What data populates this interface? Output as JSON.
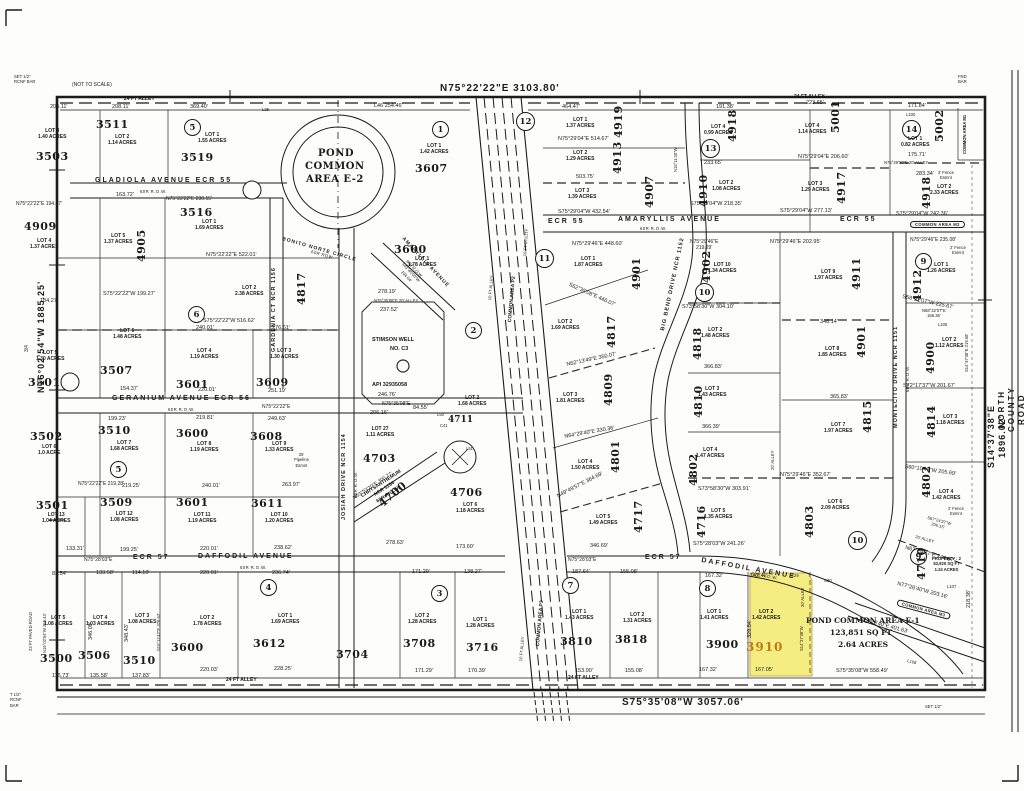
{
  "colors": {
    "ink": "#1b1b1b",
    "paper": "#fdfdfb",
    "highlight_fill": "#f5ec82",
    "highlight_text": "#c07a1a"
  },
  "boundary": {
    "north": "N75°22'22\"E   3103.80'",
    "south": "S75°35'08\"W   3057.06'",
    "west": "N16°02'54\"W   1885.25'",
    "east": "S14°37'38\"E   1896.02'"
  },
  "notes": {
    "set_bar": "SET 1/2\"\nRCNF BAR",
    "not_to_scale": "(NOT TO SCALE)",
    "fnd_bar": "FND\nBAR",
    "t_bar": "T 1/2\"\nRCNF\nBAR",
    "set_half": "SET 1/2\"",
    "three_quarter": "3/4"
  },
  "features": {
    "pond_e2": [
      "POND",
      "COMMON",
      "AREA E-2"
    ],
    "pond_e1": [
      "POND COMMON AREA E-1",
      "123,851 SQ FT",
      "2.64 ACRES"
    ],
    "well": [
      "STIMSON  WELL",
      "NO. C3",
      "API 32935058"
    ]
  },
  "streets": [
    {
      "label": "GLADIOLA AVENUE  ECR 55"
    },
    {
      "label": "60R R.O.W."
    },
    {
      "label": "ECR 55"
    },
    {
      "label": "AMARYLLIS AVENUE"
    },
    {
      "label": "ECR 55"
    },
    {
      "label": "60R R.O.W."
    },
    {
      "label": "GERANIUM AVENUE  ECR 56"
    },
    {
      "label": "60R R.O.W."
    },
    {
      "label": "N75°22'22\"E"
    },
    {
      "label": "N75°28'03\"E"
    },
    {
      "label": "ECR 57"
    },
    {
      "label": "DAFFODIL AVENUE"
    },
    {
      "label": "60R R.O.W."
    },
    {
      "label": "N75°28'03\"E"
    },
    {
      "label": "ECR 57"
    },
    {
      "label": "DAFFODIL AVENUE"
    },
    {
      "label": "60R R.O.W."
    },
    {
      "label": "JOSIAH DRIVE NCR 1154"
    },
    {
      "label": "60R R.O.W."
    },
    {
      "label": "GARDENIA CT NCR 1156"
    },
    {
      "label": "BIG BEND DRIVE NCR 1152"
    },
    {
      "label": "MONTECITO DRIVE NCR 1151"
    },
    {
      "label": "60R R.O.W."
    },
    {
      "label": "BONITO NORTE CIRCLE"
    },
    {
      "label": "60R ROW"
    },
    {
      "label": "CHRYSANTHEMUM\nNCR 1154\n60R R.O.W."
    },
    {
      "label": "AMARYLLIS AVENUE"
    },
    {
      "label": "NORTH COUNTY ROAD 1150"
    },
    {
      "label": "10 FT ALLEY"
    },
    {
      "label": "COMMON AREA P2"
    },
    {
      "label": "10 FT UTILITY"
    },
    {
      "label": "COMMON AREA P3"
    },
    {
      "label": "10 FT ALLEY"
    }
  ],
  "blocks": [
    "5",
    "1",
    "12",
    "13",
    "14",
    "11",
    "2",
    "6",
    "10",
    "9",
    "5",
    "4",
    "3",
    "7",
    "8",
    "10",
    "9"
  ],
  "lots": [
    {
      "n": "3503",
      "d": "LOT 3\n1.40 ACRES"
    },
    {
      "n": "3511",
      "d": "LOT 2\n1.14 ACRES"
    },
    {
      "n": "3519",
      "d": "LOT 1\n1.55 ACRES"
    },
    {
      "n": "3607",
      "d": "LOT 1\n1.42 ACRES"
    },
    {
      "n": "3516",
      "d": "LOT 1\n1.69 ACRES"
    },
    {
      "n": "4909",
      "d": "LOT 4\n1.37 ACRES"
    },
    {
      "n": "4905",
      "d": "LOT 5\n1.37 ACRES"
    },
    {
      "n": "3600",
      "d": "LOT 1\n1.78 ACRES"
    },
    {
      "n": "4817",
      "d": "LOT 2\n2.38 ACRES"
    },
    {
      "n": "3507",
      "d": "LOT 6\n1.48 ACRES"
    },
    {
      "n": "3501",
      "d": "LOT 5\n1.30 ACRES"
    },
    {
      "n": "3601",
      "d": "LOT 4\n1.19 ACRES"
    },
    {
      "n": "3609",
      "d": "LOT 3\n1.30 ACRES"
    },
    {
      "n": "3502",
      "d": "LOT 6\n1.0 ACRE"
    },
    {
      "n": "3510",
      "d": "LOT 7\n1.68 ACRES"
    },
    {
      "n": "3600",
      "d": "LOT 8\n1.19 ACRES"
    },
    {
      "n": "3608",
      "d": "LOT 9\n1.33 ACRES"
    },
    {
      "n": "3501",
      "d": "LOT 13\n1.04 ACRES"
    },
    {
      "n": "3509",
      "d": "LOT 12\n1.08 ACRES"
    },
    {
      "n": "3601",
      "d": "LOT 11\n1.19 ACRES"
    },
    {
      "n": "3611",
      "d": "LOT 10\n1.20 ACRES"
    },
    {
      "n": "3500",
      "d": "LOT 5\n1.08 ACRES"
    },
    {
      "n": "3506",
      "d": "LOT 4\n1.03 ACRES"
    },
    {
      "n": "3510",
      "d": "LOT 3\n1.08 ACRES"
    },
    {
      "n": "3600",
      "d": "LOT 2\n1.78 ACRES"
    },
    {
      "n": "3612",
      "d": "LOT 1\n1.69 ACRES"
    },
    {
      "n": "3704",
      "d": ""
    },
    {
      "n": "3708",
      "d": "LOT 2\n1.28 ACRES"
    },
    {
      "n": "3716",
      "d": "LOT 1\n1.28 ACRES"
    },
    {
      "n": "3810",
      "d": "LOT 1\n1.43 ACRES"
    },
    {
      "n": "3818",
      "d": "LOT 2\n1.31 ACRES"
    },
    {
      "n": "3900",
      "d": "LOT 1\n1.41 ACRES"
    },
    {
      "n": "3910",
      "d": "LOT 2\n1.42 ACRES"
    },
    {
      "n": "4703",
      "d": "LOT 27\n1.11 ACRES"
    },
    {
      "n": "4700",
      "d": ""
    },
    {
      "n": "4706",
      "d": "LOT 6\n1.18 ACRES"
    },
    {
      "n": "4711",
      "d": "LOT 2\n1.68 ACRES"
    },
    {
      "n": "4901",
      "d": "LOT 1\n1.87 ACRES"
    },
    {
      "n": "4817",
      "d": "LOT 2\n1.69 ACRES"
    },
    {
      "n": "4809",
      "d": "LOT 3\n1.81 ACRES"
    },
    {
      "n": "4801",
      "d": "LOT 4\n1.50 ACRES"
    },
    {
      "n": "4717",
      "d": "LOT 5\n1.49 ACRES"
    },
    {
      "n": "4902",
      "d": "LOT 10\n1.34 ACRES"
    },
    {
      "n": "4818",
      "d": "LOT 2\n1.48 ACRES"
    },
    {
      "n": "4810",
      "d": "LOT 3\n1.43 ACRES"
    },
    {
      "n": "4802",
      "d": "LOT 4\n1.47 ACRES"
    },
    {
      "n": "4716",
      "d": "LOT 5\n1.35 ACRES"
    },
    {
      "n": "4803",
      "d": "LOT 6\n2.09 ACRES"
    },
    {
      "n": "4815",
      "d": "LOT 7\n1.97 ACRES"
    },
    {
      "n": "4901",
      "d": "LOT 8\n1.85 ACRES"
    },
    {
      "n": "4911",
      "d": "LOT 9\n1.97 ACRES"
    },
    {
      "n": "4912",
      "d": "LOT 1\n1.26 ACRES"
    },
    {
      "n": "4900",
      "d": "LOT 2\n1.12 ACRES"
    },
    {
      "n": "4814",
      "d": "LOT 3\n1.18 ACRES"
    },
    {
      "n": "4802",
      "d": "LOT 4\n1.42 ACRES"
    },
    {
      "n": "4710",
      "d": "PROPERTY : 2\n53,920 SQ FT\n1.24 ACRES"
    },
    {
      "n": "4919",
      "d": "LOT 1\n1.37 ACRES"
    },
    {
      "n": "4913",
      "d": "LOT 2\n1.29 ACRES"
    },
    {
      "n": "4907",
      "d": "LOT 3\n1.39 ACRES"
    },
    {
      "n": "4918",
      "d": "LOT 4\n0.99 ACRES"
    },
    {
      "n": "4910",
      "d": "LOT 2\n1.08 ACRES"
    },
    {
      "n": "5001",
      "d": "LOT 4\n1.14 ACRES"
    },
    {
      "n": "4917",
      "d": "LOT 3\n1.29 ACRES"
    },
    {
      "n": "5002",
      "d": "LOT 1\n0.82 ACRES"
    },
    {
      "n": "4918",
      "d": "LOT 2\n2.33 ACRES"
    }
  ],
  "dims": [
    "206.11'",
    "208.11'",
    "369.40'",
    "L46  254.46'",
    "464.47'",
    "191.38'",
    "223.65'",
    "171.84'",
    "L100",
    "24 FT ALLEY",
    "24 FT ALLEY",
    "N75°29'04\"E 514.67'",
    "503.75'",
    "S75°29'04\"W 432.54'",
    "233.65'",
    "S75°29'04\"W 218.35'",
    "N75°29'04\"E 206.60'",
    "S75°29'04\"W 277.13'",
    "175.71'",
    "N75°29'50\"E  20' ALLEY",
    "283.34'",
    "2' Fence\nEsmnt",
    "S75°29'04\"W 242.36'",
    "COMMON AREA M2",
    "N75°29'46\"E 235.08'",
    "2' Fence\nEsmnt",
    "N75°29'46\"E 448.60'",
    "N75°29'46\"E\n219.29'",
    "N75°29'46\"E 202.95'",
    "S62°35'08\"E 446.07'",
    "N62°13'49\"E 350.07'",
    "N64°29'40\"E 330.36'",
    "N49°49'57\"E 364.69'",
    "S73°58'30\"W 304.10'",
    "348.14'",
    "366.83'",
    "365.83'",
    "366.39'",
    "N75°29'46\"E 352.67'",
    "S73°58'30\"W 303.91'",
    "S75°28'03\"W 241.26'",
    "S60°10'49\"W 205.69'",
    "S58°22'07\"W 225.67'",
    "N68°22'07\"E\n166.36'",
    "L105",
    "S72°17'37\"W 201.67'",
    "S67°24'37\"W\n200.15'",
    "N67°24'37\"E 244.67'",
    "20' ALLEY",
    "2' Fence\nEsmnt",
    "N77°26'40\"W 203.16'",
    "L107",
    "COMMON AREA M3",
    "S77°26'40\"E 401.63'",
    "S75°35'08\"W 558.49'",
    "184.27'",
    "N75°22'22\"E 194.27'",
    "163.72'",
    "N75°22'22\"E 230.15'",
    "N75°22'22\"E 522.01'",
    "S75°22'22\"W 516.62'",
    "240.01'",
    "276.61'",
    "S75°22'22\"W 199.27'",
    "154.37'",
    "220.01'",
    "251.19'",
    "199.23'",
    "219.81'",
    "249.63'",
    "25'\nPipeline\nEsmnt",
    "N75°22'22\"E 219.28'",
    "219.25'",
    "240.01'",
    "263.97'",
    "133.31'",
    "199.25'",
    "220.01'",
    "238.62'",
    "83.54'",
    "133.58'",
    "114.10'",
    "220.01'",
    "236.74'",
    "115.73'",
    "135.58'",
    "137.83'",
    "220.03'",
    "228.25'",
    "24 FT ALLEY",
    "24 FT ALLEY",
    "278.63'",
    "173.60'",
    "346.69'",
    "171.29'",
    "138.27'",
    "187.64'",
    "155.08'",
    "171.29'",
    "170.39'",
    "153.90'",
    "155.08'",
    "167.32'",
    "142.42'",
    "C29",
    "C30",
    "329.84'",
    "167.05'",
    "167.32'",
    "S14°37'38\"W",
    "20' ALLEY",
    "278.19'",
    "N75°35'08\"E   20' ALLEY",
    "237.52'",
    "246.76'",
    "N75°35'08\"E",
    "206.16'",
    "84.55'",
    "N53°53'20\"E 300.77'",
    "L50",
    "C41",
    "L51",
    "N15°11'40\"W",
    "S15°11'42\"E 328.62'",
    "346.09'",
    "348.43'",
    "N16°02'54\"W 255.43'",
    "23 FT PAVED ROAD",
    "S14°37'38\"E 219.68'",
    "218.38'",
    "20' ALLEY",
    "L25",
    "60R R.O.W.\nS43°40'00\"W\n194.04'",
    "COMMON AREA M1",
    "L108"
  ]
}
